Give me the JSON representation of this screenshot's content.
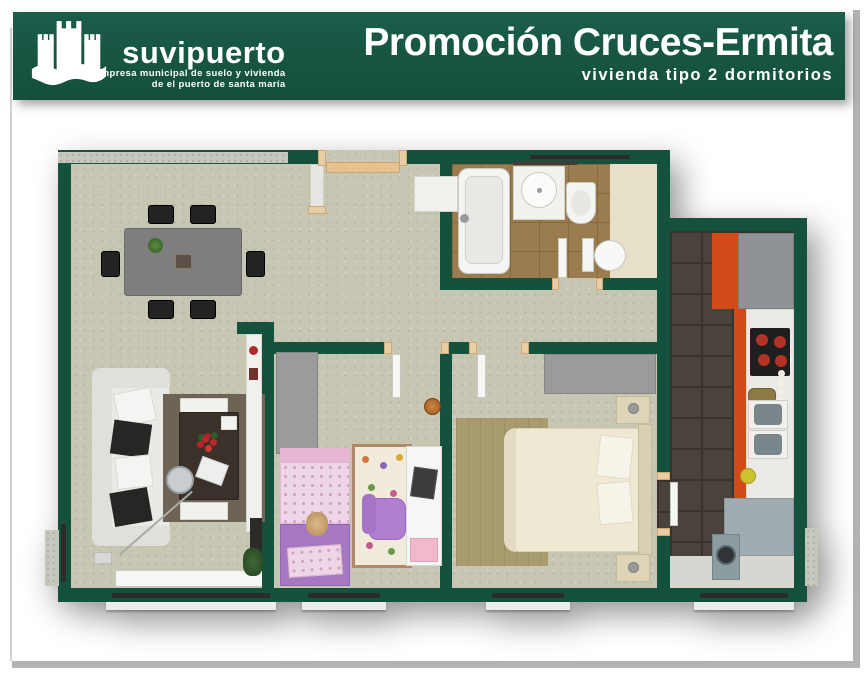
{
  "header": {
    "logo": {
      "icon": "castle-icon",
      "name": "suvipuerto",
      "tagline_line1": "empresa municipal de suelo y vivienda",
      "tagline_line2": "de el puerto de santa maría"
    },
    "title": "Promoción Cruces-Ermita",
    "subtitle": "vivienda tipo 2 dormitorios"
  },
  "colors": {
    "brand_green": "#175546",
    "wall_green": "#14523e",
    "carpet_beige": "#c7c6b2",
    "bath_tile_brown": "#9a7c4e",
    "bath_floor_cream": "#e7e0c8",
    "kitchen_tile_dark": "#4a423c",
    "kitchen_cabinet_orange": "#d14b18",
    "door_wood_beige": "#e9cda4",
    "concrete_gray": "#c6c6bc",
    "kid_bed_purple": "#a678c2",
    "kid_bed_pink": "#eed6e6",
    "master_bed_cream": "#efe9d3",
    "frame_gray": "#b3b3b3"
  },
  "floorplan": {
    "type": "2-bedroom apartment 3D plan",
    "rooms": [
      {
        "id": "dining-room"
      },
      {
        "id": "entrance-hall"
      },
      {
        "id": "bathroom"
      },
      {
        "id": "corridor"
      },
      {
        "id": "living-room"
      },
      {
        "id": "children-bedroom"
      },
      {
        "id": "master-bedroom"
      },
      {
        "id": "kitchen"
      }
    ]
  }
}
